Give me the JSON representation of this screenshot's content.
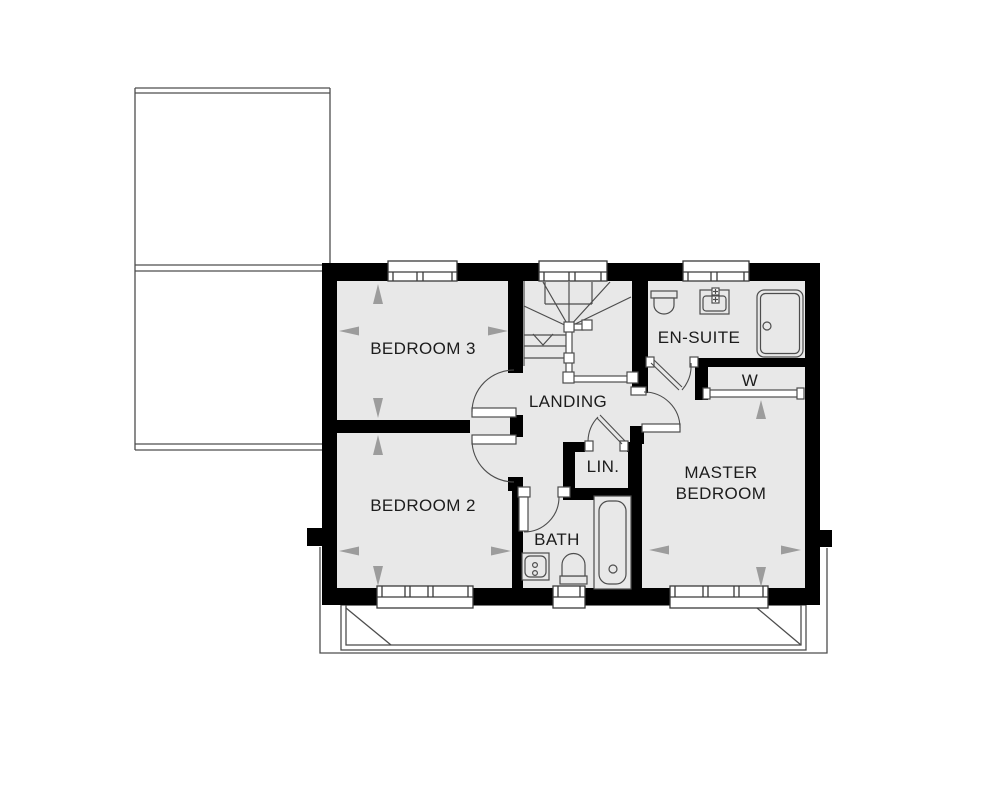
{
  "rooms": {
    "bedroom3": {
      "label": "BEDROOM 3"
    },
    "bedroom2": {
      "label": "BEDROOM 2"
    },
    "landing": {
      "label": "LANDING"
    },
    "linen": {
      "label": "LIN."
    },
    "bath": {
      "label": "BATH"
    },
    "ensuite": {
      "label": "EN-SUITE"
    },
    "wardrobe": {
      "label": "W"
    },
    "master": {
      "label": "MASTER BEDROOM"
    }
  },
  "stairs": {
    "direction": "down"
  },
  "fixtures": [
    "toilet",
    "wash-basin",
    "shower",
    "wardrobe-rail",
    "bathtub",
    "toilet",
    "wash-basin"
  ],
  "colors": {
    "wall": "#000000",
    "floor": "#e8e8e8",
    "outline": "#4d4d4d",
    "window_frame": "#3a3a3a",
    "dimension_arrow": "#9c9c9c",
    "text": "#1c1c1c"
  }
}
